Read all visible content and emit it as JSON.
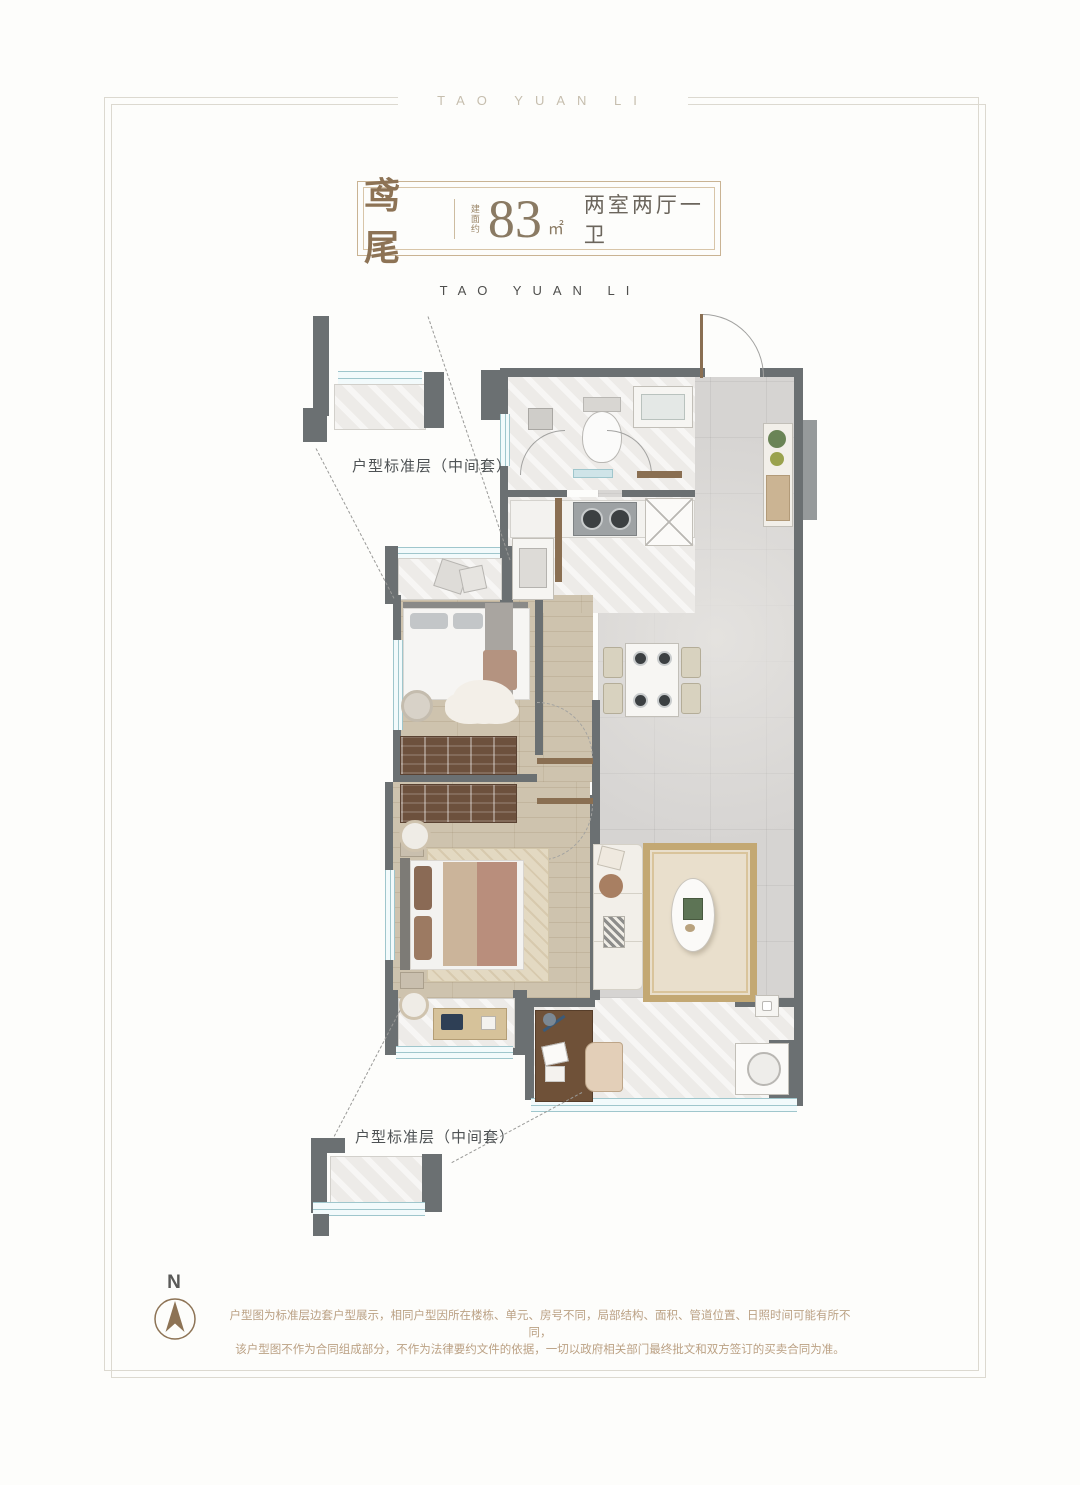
{
  "frame": {
    "top_text": "TAO YUAN LI"
  },
  "title": {
    "name": "鸢尾",
    "area_label": "建面约",
    "area_value": "83",
    "area_unit": "㎡",
    "layout": "两室两厅一卫"
  },
  "subtitle": "TAO YUAN LI",
  "callouts": {
    "top": "户型标准层（中间套）",
    "bottom": "户型标准层（中间套）"
  },
  "compass": {
    "label": "N"
  },
  "disclaimer": {
    "line1": "户型图为标准层边套户型展示，相同户型因所在楼栋、单元、房号不同，局部结构、面积、管道位置、日照时间可能有所不同，",
    "line2": "该户型图不作为合同组成部分，不作为法律要约文件的依据，一切以政府相关部门最终批文和双方签订的买卖合同为准。"
  },
  "colors": {
    "accent_gold": "#8d7355",
    "wall_gray": "#6b7072",
    "window_blue": "#9fc6cc",
    "text_dark": "#4e5254",
    "disclaimer_tan": "#bba184"
  }
}
